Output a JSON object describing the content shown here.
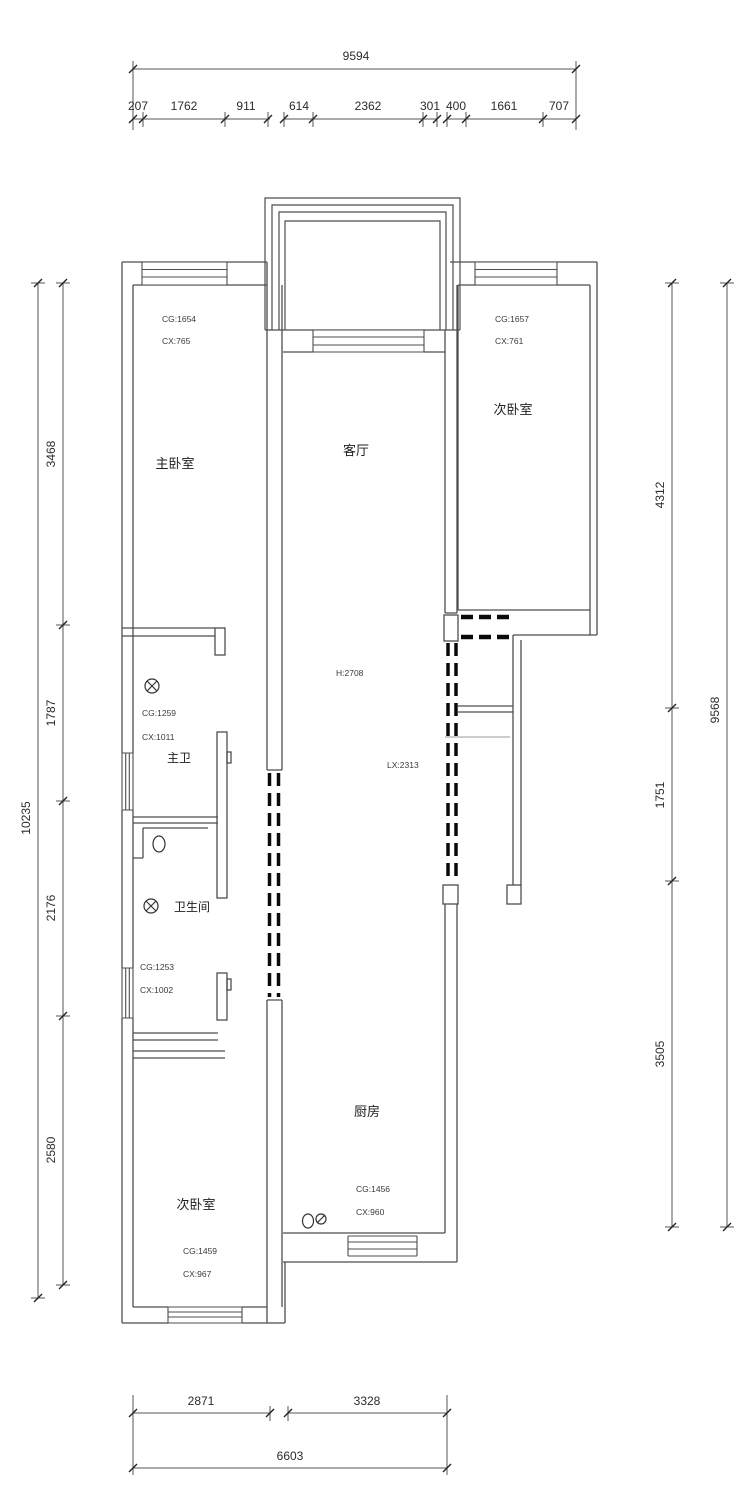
{
  "drawing": {
    "type": "apartment-floor-plan",
    "background": "#ffffff",
    "wall_line_color": "#4d4d4d",
    "bold_dash_color": "#0a0a0a",
    "text_color": "#2b2b2b"
  },
  "dimensions": {
    "top": {
      "total": "9594",
      "segments": [
        "207",
        "1762",
        "911",
        "614",
        "2362",
        "301",
        "400",
        "1661",
        "707"
      ]
    },
    "left": {
      "total": "10235",
      "segments": [
        "3468",
        "1787",
        "2176",
        "2580"
      ]
    },
    "right": {
      "total": "9568",
      "segments": [
        "4312",
        "1751",
        "3505"
      ]
    },
    "bottom": {
      "total": "6603",
      "segments": [
        "2871",
        "3328"
      ]
    }
  },
  "rooms": {
    "master_bedroom": {
      "label": "主卧室",
      "cg": "CG:1654",
      "cx": "CX:765"
    },
    "living_room": {
      "label": "客厅",
      "height_note": "H:2708",
      "lx_note": "LX:2313"
    },
    "bedroom_top_right": {
      "label": "次卧室",
      "cg": "CG:1657",
      "cx": "CX:761"
    },
    "master_bath": {
      "label": "主卫",
      "cg": "CG:1259",
      "cx": "CX:1011"
    },
    "bathroom": {
      "label": "卫生间",
      "cg": "CG:1253",
      "cx": "CX:1002"
    },
    "bedroom_bottom_left": {
      "label": "次卧室",
      "cg": "CG:1459",
      "cx": "CX:967"
    },
    "kitchen": {
      "label": "厨房",
      "cg": "CG:1456",
      "cx": "CX:960"
    }
  }
}
